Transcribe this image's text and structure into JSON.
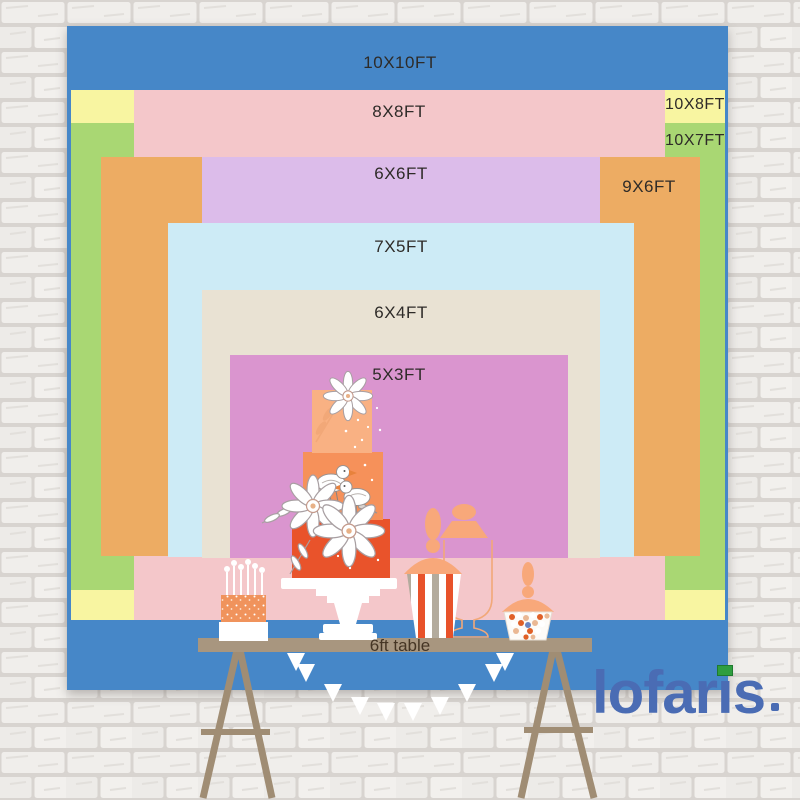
{
  "product": {
    "type": "backdrop-size-comparison-chart",
    "setting": "dessert table in front of white brick wall"
  },
  "sizes": [
    {
      "label": "10X10FT",
      "width_ft": 10,
      "height_ft": 10,
      "color": "#4687c8"
    },
    {
      "label": "10X8FT",
      "width_ft": 10,
      "height_ft": 8,
      "color": "#f8f5a1"
    },
    {
      "label": "10X7FT",
      "width_ft": 10,
      "height_ft": 7,
      "color": "#a9d773"
    },
    {
      "label": "8X8FT",
      "width_ft": 8,
      "height_ft": 8,
      "color": "#f4c7ca"
    },
    {
      "label": "9X6FT",
      "width_ft": 9,
      "height_ft": 6,
      "color": "#edac63"
    },
    {
      "label": "6X6FT",
      "width_ft": 6,
      "height_ft": 6,
      "color": "#dcbcea"
    },
    {
      "label": "7X5FT",
      "width_ft": 7,
      "height_ft": 5,
      "color": "#cdebf6"
    },
    {
      "label": "6X4FT",
      "width_ft": 6,
      "height_ft": 4,
      "color": "#e9e2d3"
    },
    {
      "label": "5X3FT",
      "width_ft": 5,
      "height_ft": 3,
      "color": "#da95cf"
    }
  ],
  "table": {
    "label": "6ft table",
    "color": "#a8967f"
  },
  "brand": {
    "name": "lofaris",
    "color": "#4a6cb4",
    "accent_color": "#2f9e3f"
  },
  "illustrations": [
    "tiered-wedding-cake",
    "cake-stand",
    "flowers",
    "birds",
    "candle-cake",
    "popcorn-striped-jar",
    "candy-jar",
    "apothecary-jar-outline",
    "bunting-pennants",
    "trestle-table-legs",
    "white-brick-wall"
  ],
  "palette": {
    "cake_top_tier": "#f9b183",
    "cake_middle_tier": "#f6915a",
    "cake_bottom_tier": "#e9532b",
    "peach_lid": "#f8a87a",
    "stripe_red": "#e8522a",
    "stripe_tan": "#b3ab9d",
    "wall_brick": "#f0eeeb",
    "wall_mortar": "#d8d4d0"
  }
}
